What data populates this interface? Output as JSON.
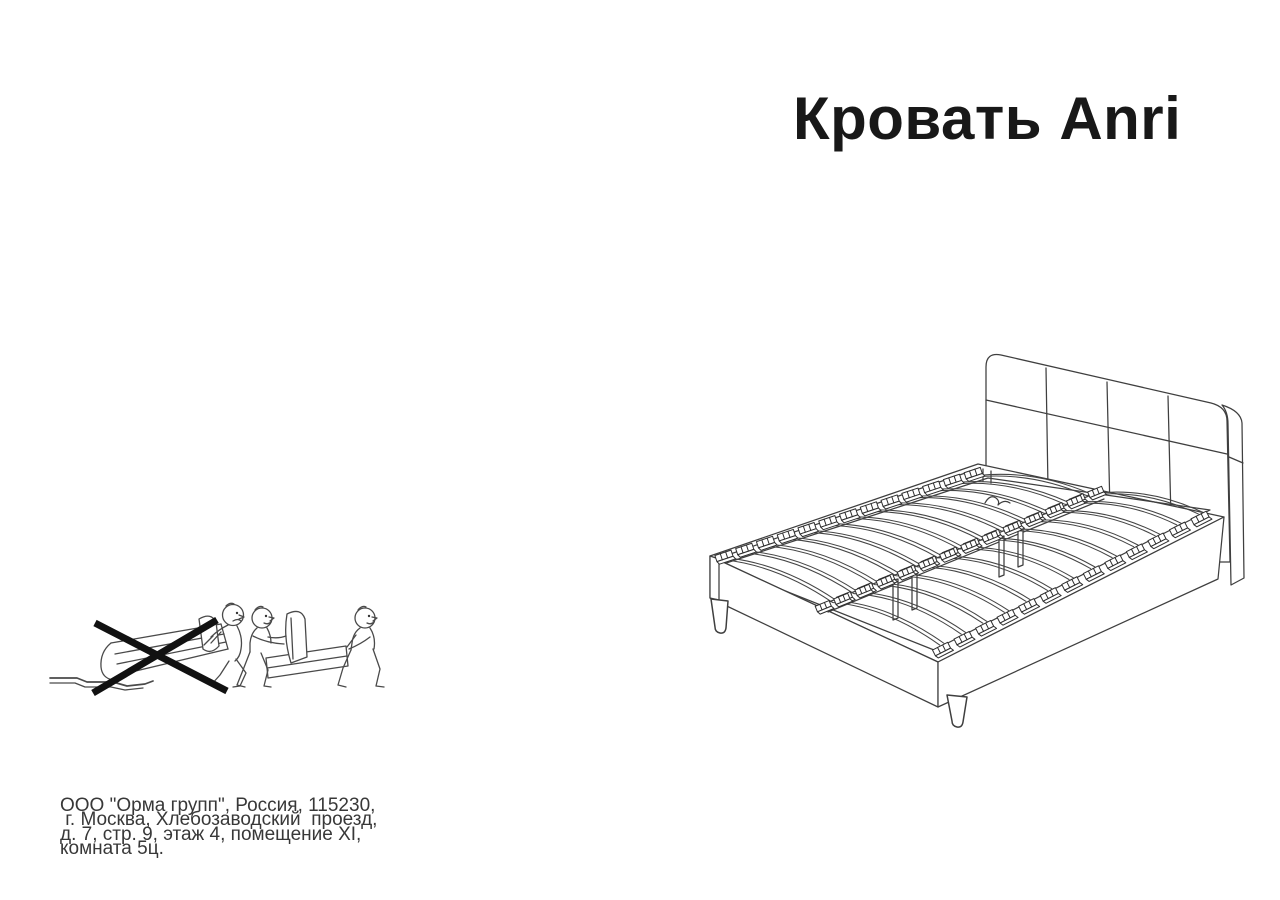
{
  "page": {
    "title": "Кровать Anri"
  },
  "manufacturer": {
    "address_lines": [
      "ООО \"Орма групп\", Россия, 115230,",
      " г. Москва, Хлебозаводский  проезд,",
      "д. 7, стр. 9, этаж 4, помещение XI,",
      "комната 5ц."
    ]
  },
  "illustrations": {
    "bed_drawing": "bed-with-slatted-base-and-padded-headboard",
    "warning_icons": [
      "do-not-drag-alone-icon",
      "carry-with-two-people-icon"
    ]
  },
  "colors": {
    "background": "#ffffff",
    "line_art": "#3f3f3f",
    "ink": "#181818",
    "prohibition_cross": "#111111"
  }
}
